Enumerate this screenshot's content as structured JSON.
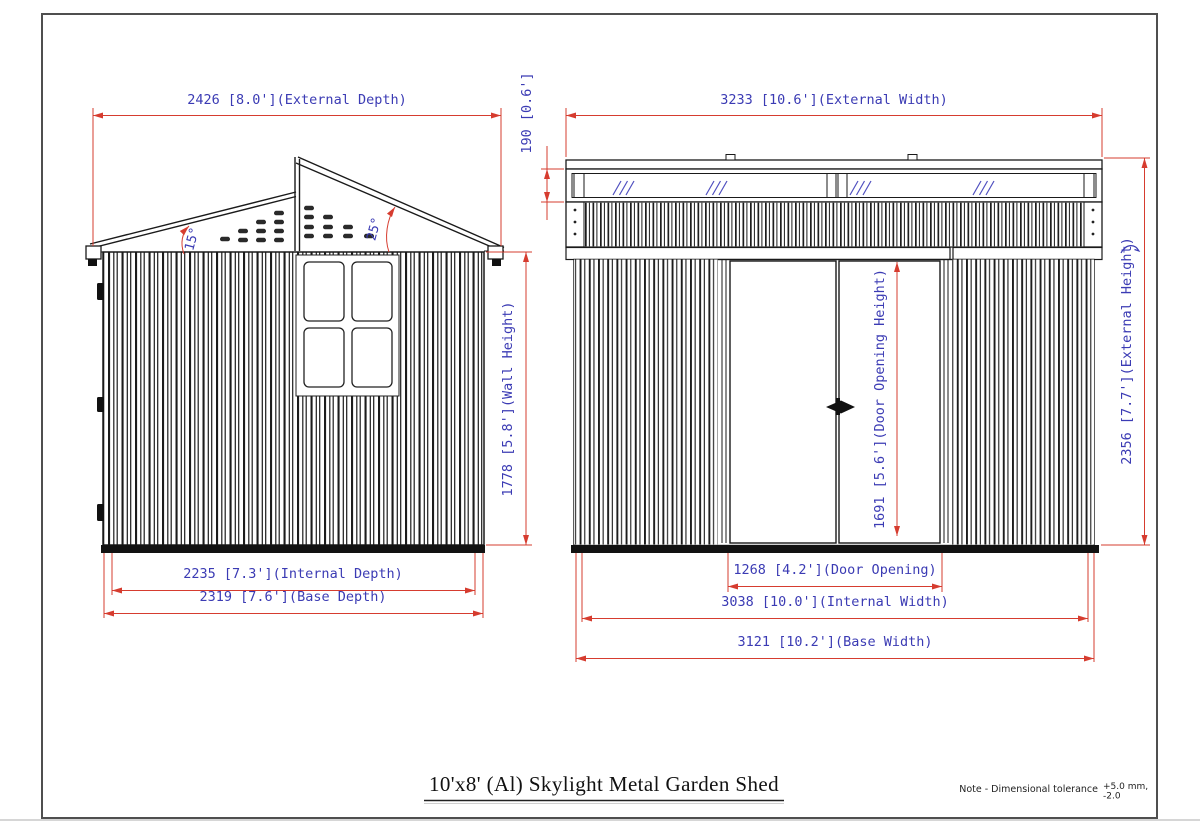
{
  "drawing": {
    "title": "10'x8' (Al) Skylight Metal Garden Shed",
    "note": {
      "label": "Note - Dimensional tolerance",
      "tolerance_plus": "+5.0 mm,",
      "tolerance_minus": "-2.0"
    },
    "side_view": {
      "external_depth": "2426 [8.0'](External Depth)",
      "internal_depth": "2235 [7.3'](Internal Depth)",
      "base_depth": "2319 [7.6'](Base Depth)",
      "wall_height": "1778 [5.8'](Wall Height)",
      "roof_angle_rear": "15°",
      "roof_angle_front": "25°"
    },
    "front_view": {
      "external_width": "3233 [10.6'](External Width)",
      "internal_width": "3038 [10.0'](Internal Width)",
      "base_width": "3121 [10.2'](Base Width)",
      "external_height": "2356 [7.7'](External Height)",
      "skylight_height": "190 [0.6']",
      "door_opening_width": "1268 [4.2'](Door Opening)",
      "door_opening_height": "1691 [5.6'](Door Opening Height)"
    },
    "colors": {
      "dimension_line": "#d63c2f",
      "dimension_text": "#3b3bb4",
      "drawing_line": "#1a1a1a"
    }
  }
}
